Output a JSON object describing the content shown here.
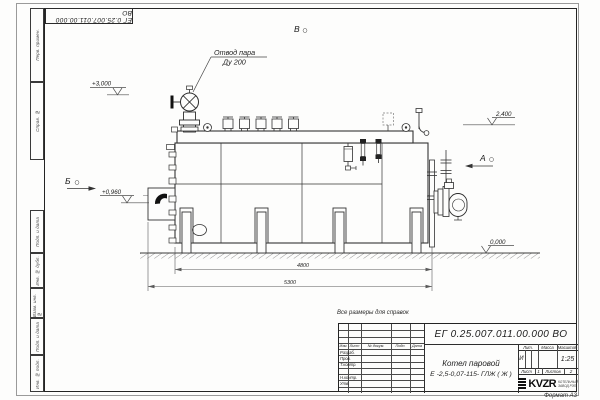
{
  "sheet": {
    "note_reference": "Все размеры для справок",
    "format": "Формат А3",
    "top_stamp": "ЕГ 0.25.007.011.00.000  ВО",
    "margin_boxes": [
      "Перв. примен.",
      "Справ. №",
      "Подп. и дата",
      "Инв. № дубл.",
      "Взам. инв. №",
      "Подп. и дата",
      "Инв. № подл."
    ]
  },
  "drawing": {
    "callout": {
      "line1": "Отвод пара",
      "line2": "Ду 200"
    },
    "views": {
      "top": "В",
      "left": "Б",
      "right": "А"
    },
    "elevations": {
      "valve_top": "+3,000",
      "boiler_top": "2,400",
      "burner_axis": "+0,960",
      "ground": "0,000"
    },
    "dimensions": {
      "supports_span": "4800",
      "overall_length": "5300"
    }
  },
  "title_block": {
    "designation": "ЕГ 0.25.007.011.00.000  ВО",
    "product_name_line1": "Котел паровой",
    "product_name_line2": "Е -2,5-0,07-115- ГЛЖ ( Ж )",
    "col_headers": {
      "lit": "Лит.",
      "mass": "Масса",
      "scale": "Масштаб"
    },
    "litera": "И",
    "scale": "1:25",
    "sheet": {
      "label": "Лист",
      "value": "1"
    },
    "sheets": {
      "label": "Листов",
      "value": "2"
    },
    "sign_rows": {
      "header": [
        "Изм.",
        "Лист",
        "№ докум.",
        "Подп.",
        "Дата"
      ],
      "labels": [
        "Разраб.",
        "Пров.",
        "Т.контр.",
        "Н.контр.",
        "Утв."
      ]
    },
    "company": {
      "logo": "KVZR",
      "line1": "КОТЕЛЬНЫЙ",
      "line2": "ЗАВОД РЭП"
    }
  },
  "colors": {
    "line": "#2e2e2e",
    "paper": "#fdfdfc",
    "flame": "#111111"
  }
}
